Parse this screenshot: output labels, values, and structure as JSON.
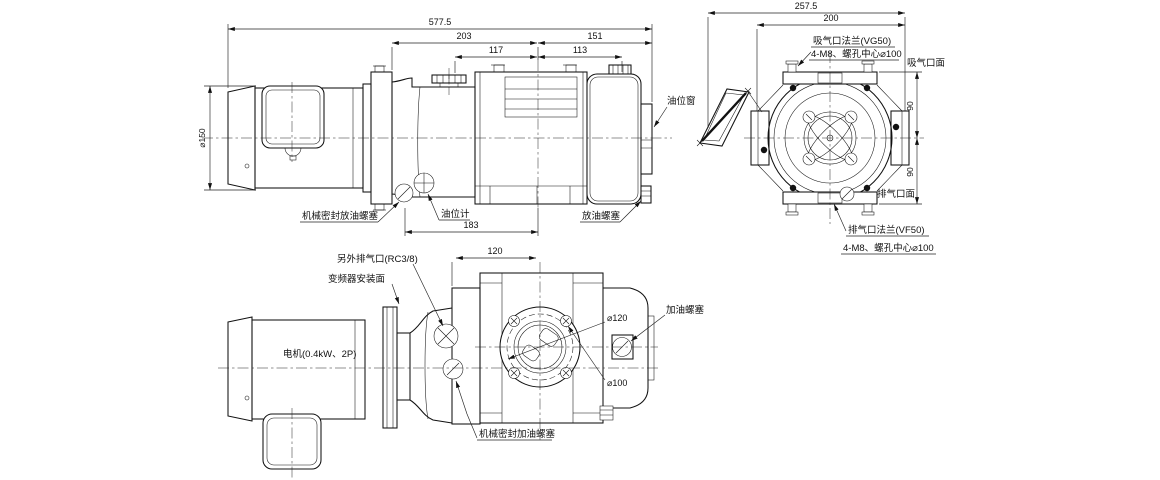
{
  "side_view": {
    "dims": {
      "overall": "577.5",
      "pump_section": "203",
      "tank_section": "151",
      "front_section": "117",
      "rear_section": "113",
      "motor_diameter": "⌀150",
      "base_length": "183"
    },
    "labels": {
      "oil_level_window": "油位窗",
      "mech_seal_drain_plug": "机械密封放油螺塞",
      "oil_level_gauge": "油位计",
      "oil_drain_plug": "放油螺塞"
    }
  },
  "end_view": {
    "dims": {
      "overall_depth": "257.5",
      "body_depth": "200",
      "suction_to_center": "90",
      "center_to_exhaust": "90"
    },
    "labels": {
      "suction_flange": "吸气口法兰(VG50)",
      "suction_bolt_circle": "4-M8、螺孔中心⌀100",
      "suction_face": "吸气口面",
      "exhaust_face": "排气口面",
      "exhaust_flange": "排气口法兰(VF50)",
      "exhaust_bolt_circle": "4-M8、螺孔中心⌀100"
    }
  },
  "bottom_view": {
    "dims": {
      "port_offset": "120",
      "flange_diameter": "⌀120",
      "bolt_circle": "⌀100"
    },
    "labels": {
      "aux_exhaust_port": "另外排气口(RC3/8)",
      "inverter_mount_face": "变频器安装面",
      "motor_spec": "电机(0.4kW、2P)",
      "oil_fill_plug": "加油螺塞",
      "mech_seal_fill_plug": "机械密封加油螺塞"
    }
  }
}
